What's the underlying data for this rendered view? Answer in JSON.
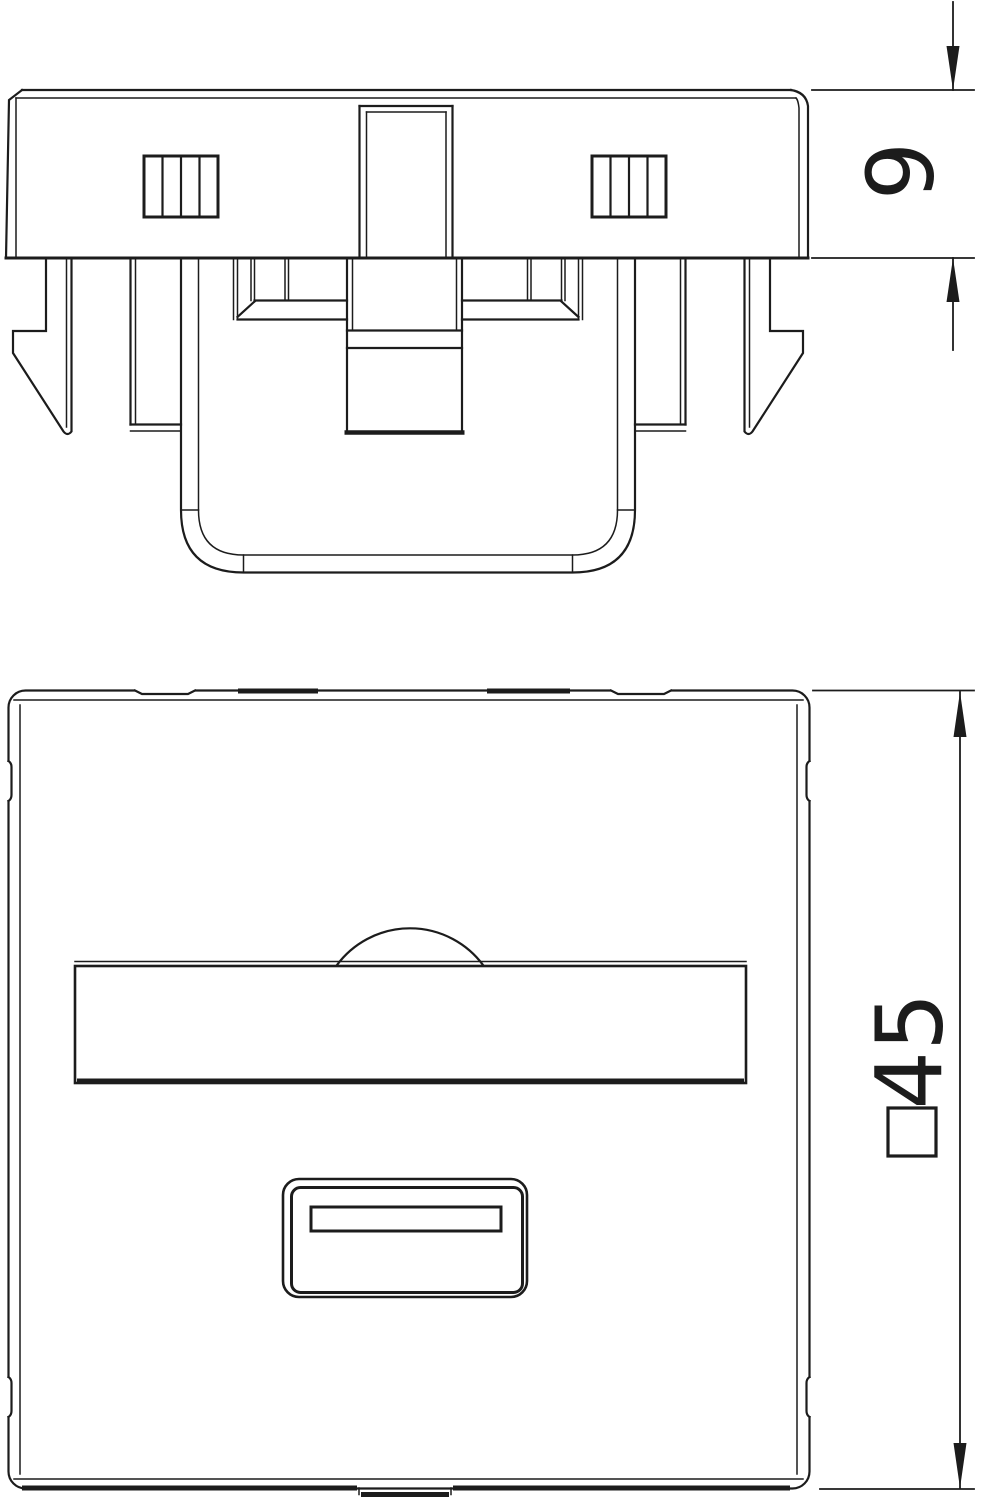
{
  "page": {
    "background": "#ffffff",
    "line_color": "#1c1c1c"
  },
  "dimensions": {
    "module_height": "9",
    "plate_size": "45",
    "plate_size_prefix": "□",
    "plate_size_full": "□45"
  }
}
